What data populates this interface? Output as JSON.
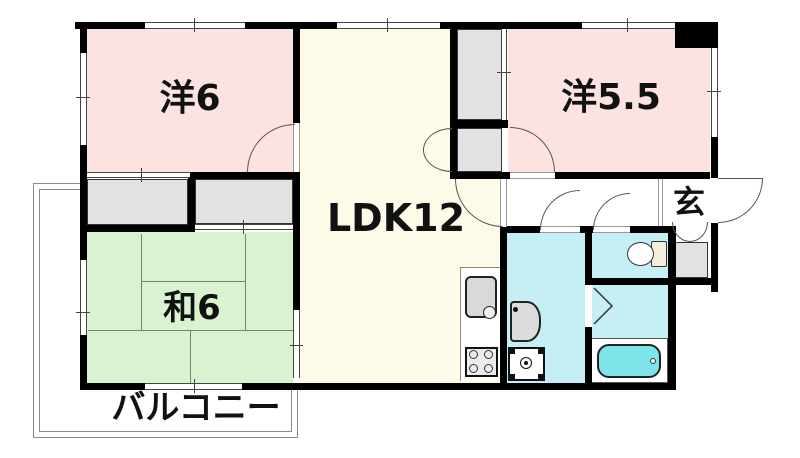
{
  "plan": {
    "title": "apartment-floor-plan",
    "rooms": {
      "western6": {
        "label": "洋6",
        "type": "western-style room",
        "size_tatami": 6
      },
      "western55": {
        "label": "洋5.5",
        "type": "western-style room",
        "size_tatami": 5.5
      },
      "ldk": {
        "label": "LDK12",
        "type": "living-dining-kitchen",
        "size_tatami": 12
      },
      "japanese6": {
        "label": "和6",
        "type": "japanese-style tatami room",
        "size_tatami": 6
      },
      "balcony": {
        "label": "バルコニー",
        "type": "balcony"
      },
      "entrance": {
        "label": "玄",
        "type": "entrance (genkan)"
      }
    },
    "fixtures": [
      "kitchen-sink",
      "gas-stove",
      "washbasin",
      "washing-machine",
      "washer-pan",
      "toilet",
      "bathtub",
      "shoe-cabinet"
    ],
    "colors": {
      "western_room": "#fae3e1",
      "ldk": "#fdfbe7",
      "japanese_room": "#d9f3d0",
      "wet_area": "#c5eff4",
      "bathtub": "#7de4ea",
      "closet": "#e2e2e2",
      "wall": "#000000"
    }
  }
}
